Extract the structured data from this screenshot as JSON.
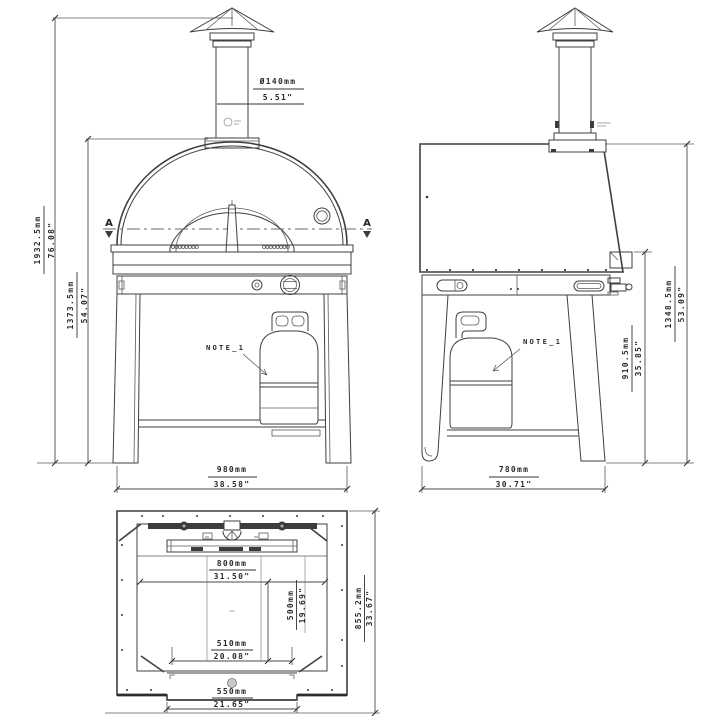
{
  "front_view": {
    "sec_a_left": "A",
    "sec_a_right": "A",
    "chimney_dia_mm": "Ø140mm",
    "chimney_dia_in": "5.51\"",
    "overall_h_mm": "1932.5mm",
    "overall_h_in": "76.08\"",
    "body_h_mm": "1373.5mm",
    "body_h_in": "54.07\"",
    "width_mm": "980mm",
    "width_in": "38.58\"",
    "note": "NOTE_1"
  },
  "side_view": {
    "depth_mm": "780mm",
    "depth_in": "30.71\"",
    "counter_h_mm": "910.5mm",
    "counter_h_in": "35.85\"",
    "overall_h_mm": "1348.5mm",
    "overall_h_in": "53.09\"",
    "note": "NOTE_1"
  },
  "top_view": {
    "width_mm": "800mm",
    "width_in": "31.50\"",
    "depth_mm": "500mm",
    "depth_in": "19.69\"",
    "door_mm": "510mm",
    "door_in": "20.08\"",
    "opening_mm": "550mm",
    "opening_in": "21.65\"",
    "overall_mm": "855.2mm",
    "overall_in": "33.67\""
  },
  "colors": {
    "line": "#3f3f3f",
    "text": "#2b2b2b",
    "background": "#ffffff"
  }
}
